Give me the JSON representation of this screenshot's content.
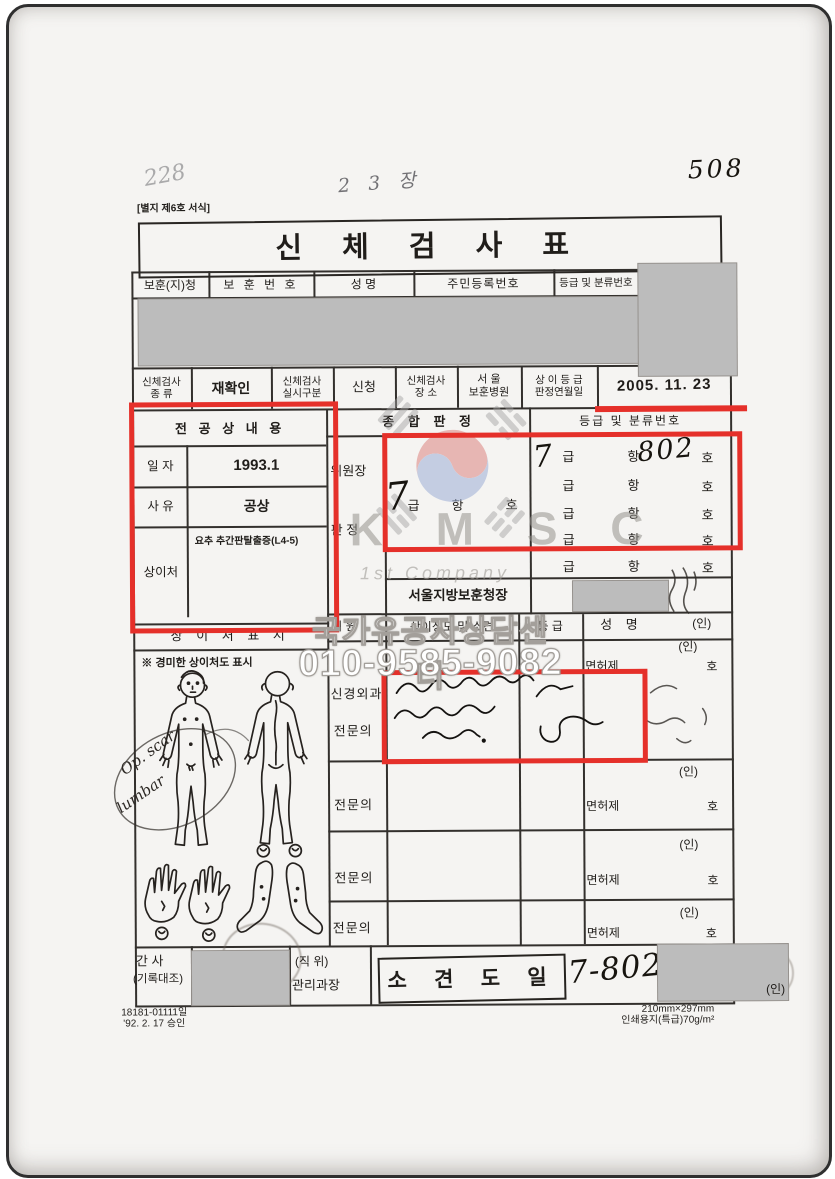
{
  "page": {
    "marks": {
      "top_left": "228",
      "top_center": "2 3 장",
      "top_right": "508"
    },
    "form_ref": "[별지 제6호 서식]",
    "title": "신 체 검 사 표"
  },
  "id_row": {
    "c1": "보훈(지)청",
    "c2": "보 훈 번 호",
    "c3": "성    명",
    "c4": "주민등록번호",
    "c5": "등급 및 분류번호"
  },
  "exam_row": {
    "kind_l1": "신체검사",
    "kind_l2": "종   류",
    "kind_value": "재확인",
    "mode_l1": "신체검사",
    "mode_l2": "실시구분",
    "mode_value": "신청",
    "place_l1": "신체검사",
    "place_l2": "장   소",
    "place_v1": "서   울",
    "place_v2": "보훈병원",
    "date_l1": "상 이 등 급",
    "date_l2": "판정연월일",
    "date_value": "2005. 11. 23"
  },
  "injury": {
    "title": "전 공 상 내 용",
    "date_label": "일  자",
    "date_value": "1993.1",
    "cause_label": "사  유",
    "cause_value": "공상",
    "site_label": "상이처",
    "site_value": "요추 추간판탈출증(L4-5)"
  },
  "judgment": {
    "header": "종 합 판 정",
    "chairman": "위원장",
    "decision": "판   정",
    "hand_grade": "7",
    "geup": "급",
    "hang": "항",
    "ho": "호",
    "office": "서울지방보훈청장"
  },
  "grades": {
    "header": "등급 및 분류번호",
    "geup": "급",
    "hang": "항",
    "ho": "호",
    "hand_grade": "7",
    "hand_number": "802"
  },
  "committee": {
    "member": "위   원",
    "opinion": "상이정도 및 소견",
    "grade": "등  급",
    "name": "성    명",
    "seal": "(인)"
  },
  "specialists": {
    "dept": "신경외과",
    "title": "전문의",
    "license": "면허제",
    "license_ho": "호",
    "seal": "(인)"
  },
  "body_chart": {
    "header": "상 이 처 표 시",
    "note": "※ 경미한 상이처도 표시",
    "scar_1": "Op. scar",
    "scar_2": "lumbar"
  },
  "bottom": {
    "sec_l1": "간   사",
    "sec_l2": "(기록대조)",
    "pos_l1": "(직  위)",
    "pos_l2": "관리과장",
    "stamp": "소 견 도 일",
    "hand": "7-802",
    "seal": "(인)"
  },
  "footer": {
    "doc_no": "18181-01111일",
    "approved": "'92. 2. 17 승인",
    "size": "210mm×297mm",
    "paper": "인쇄용지(특급)70g/m²"
  },
  "watermark": {
    "kmsc": "K M S C",
    "company": "1st Company",
    "center": "국가유공자상담센터",
    "phone": "010-9585-9082"
  },
  "colors": {
    "highlight_red": "#e5302a",
    "redaction_gray": "#bcbcbc",
    "flag_red": "#dd8581",
    "flag_blue": "#9dafd6",
    "trigram_gray": "#a0a0a0"
  }
}
